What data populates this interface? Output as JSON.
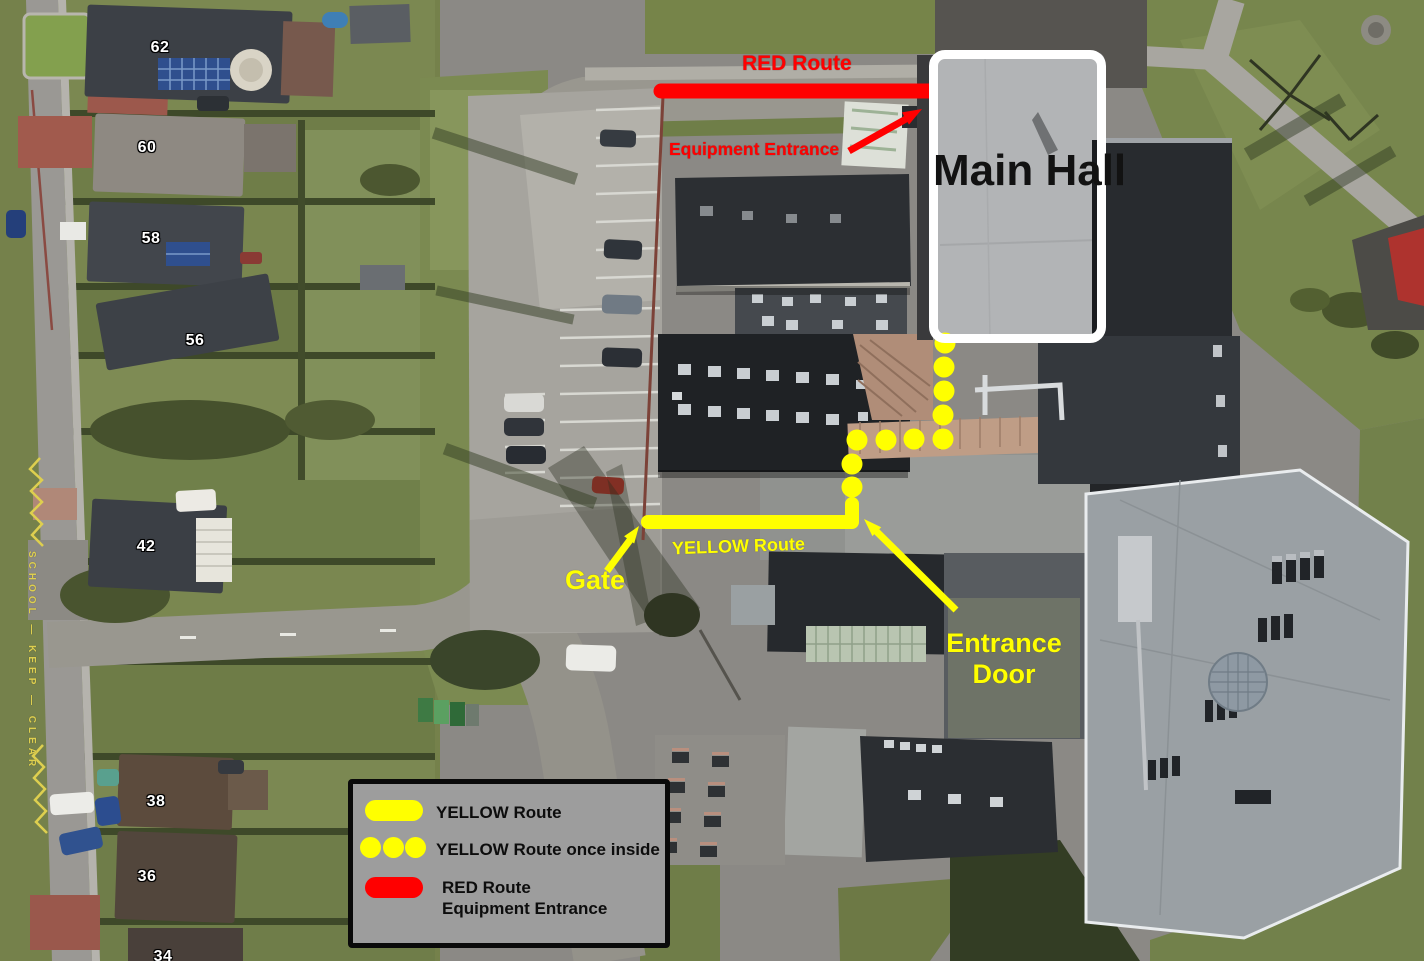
{
  "annotations": {
    "red_route": "RED Route",
    "equipment_entrance": "Equipment Entrance",
    "main_hall": "Main Hall",
    "yellow_route": "YELLOW Route",
    "gate": "Gate",
    "entrance_door": "Entrance Door"
  },
  "legend": {
    "items": [
      {
        "symbol": "yellow-line",
        "label": "YELLOW Route"
      },
      {
        "symbol": "yellow-dots",
        "label": "YELLOW Route once inside"
      },
      {
        "symbol": "red-line",
        "label": "RED Route",
        "sublabel": "Equipment Entrance"
      }
    ]
  },
  "map_labels": {
    "house_numbers": [
      "62",
      "60",
      "58",
      "56",
      "42",
      "38",
      "36",
      "34"
    ],
    "road_marking": "SCHOOL — KEEP — CLEAR"
  },
  "colors": {
    "red_route": "#ff0000",
    "yellow_route": "#ffff00",
    "main_hall_outline": "#ffffff",
    "main_hall_text": "#121212",
    "legend_background": "#9d9d9d",
    "legend_border": "#0a0a0a",
    "road_marking_paint": "#decf4f"
  }
}
